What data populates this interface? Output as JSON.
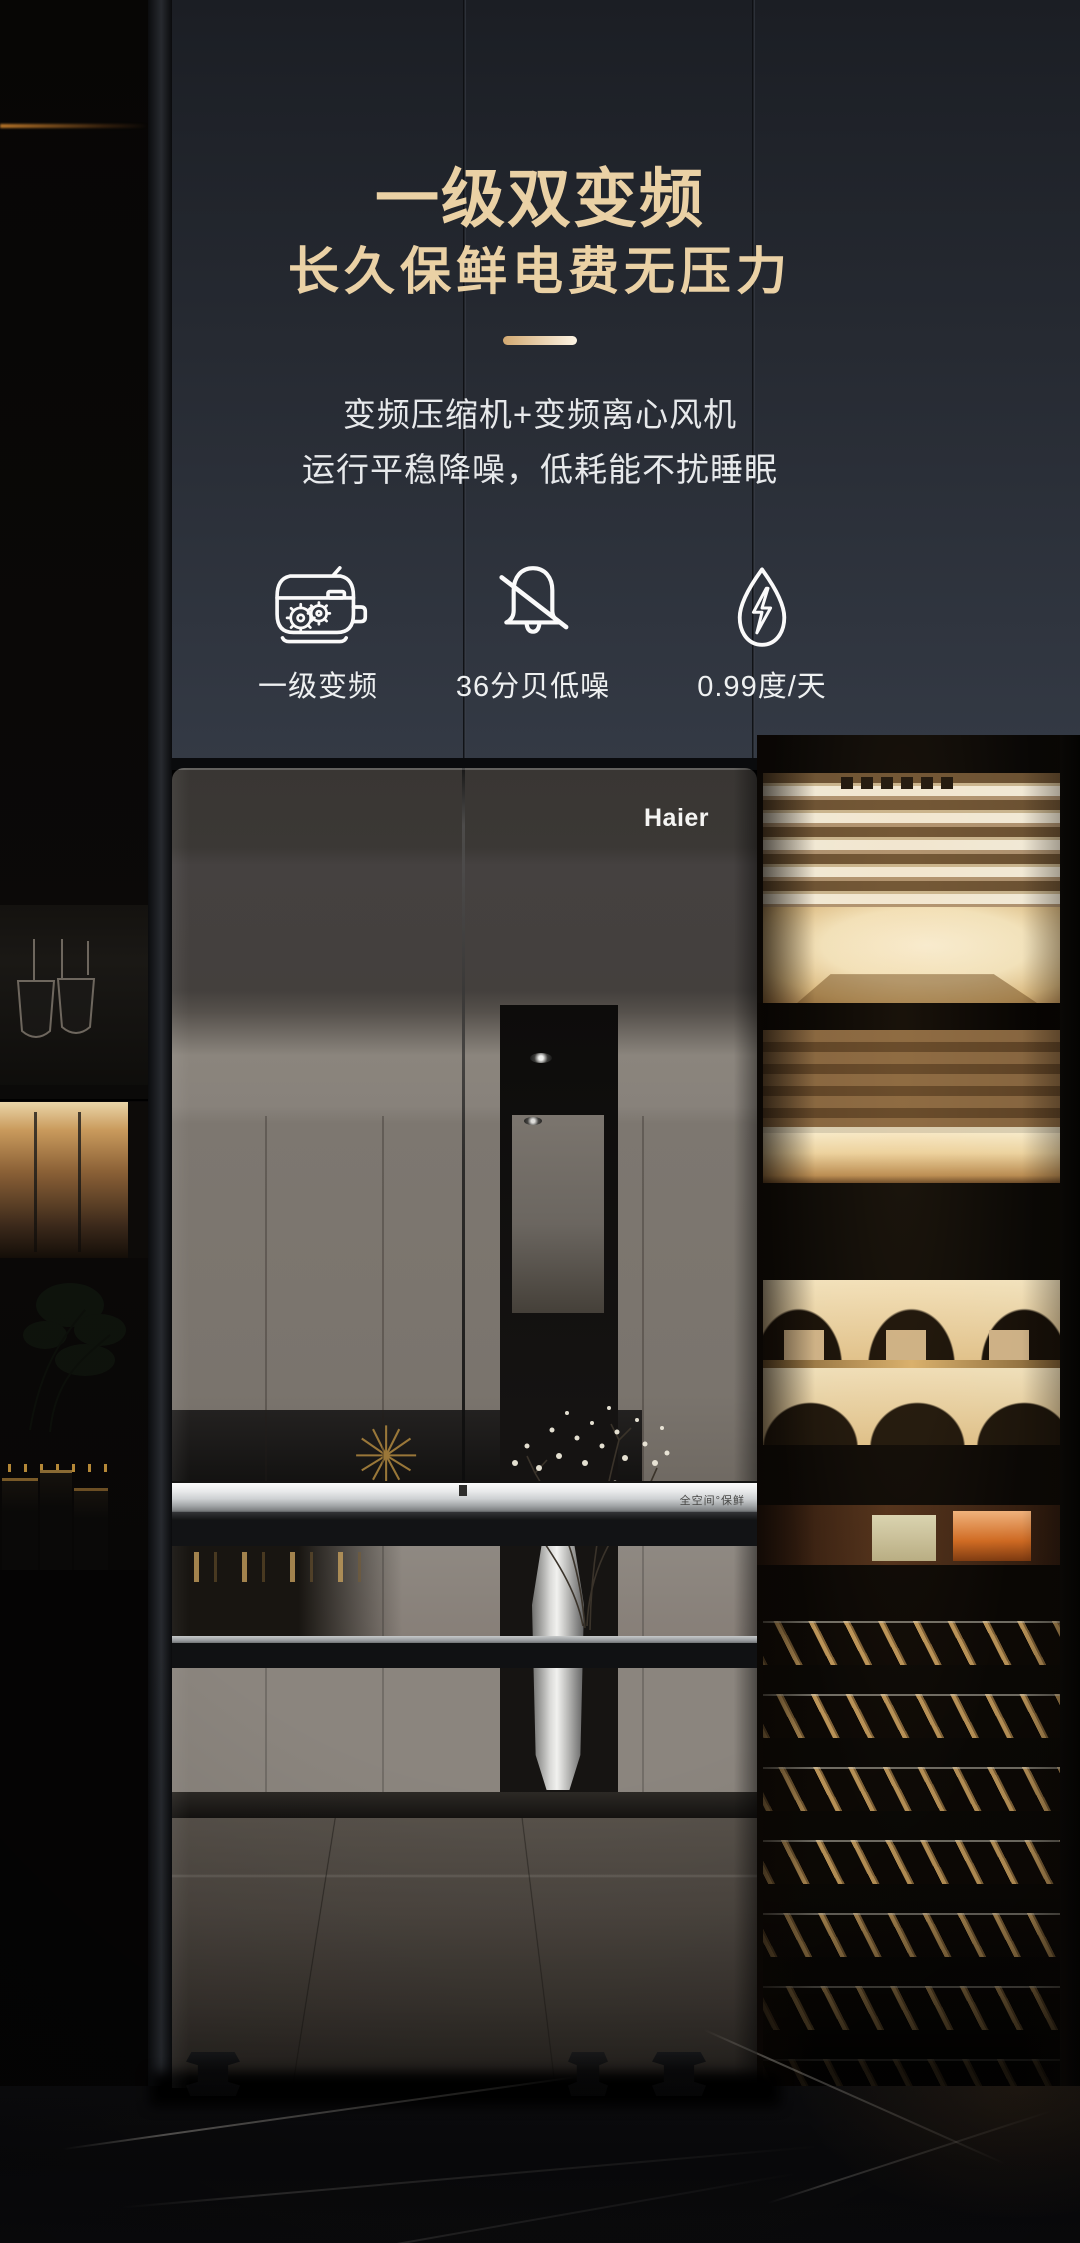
{
  "hero": {
    "title_line1": "一级双变频",
    "title_line2": "长久保鲜电费无压力",
    "desc_line1": "变频压缩机+变频离心风机",
    "desc_line2": "运行平稳降噪，低耗能不扰睡眠"
  },
  "features": [
    {
      "icon": "compressor-icon",
      "label": "一级变频"
    },
    {
      "icon": "mute-bell-icon",
      "label": "36分贝低噪"
    },
    {
      "icon": "energy-drop-icon",
      "label": "0.99度/天"
    }
  ],
  "fridge": {
    "brand": "Haier",
    "handle_badge": "全空间°保鲜"
  },
  "colors": {
    "accent_gold": "#EAD1A5",
    "text_white": "#E7E9EB"
  }
}
